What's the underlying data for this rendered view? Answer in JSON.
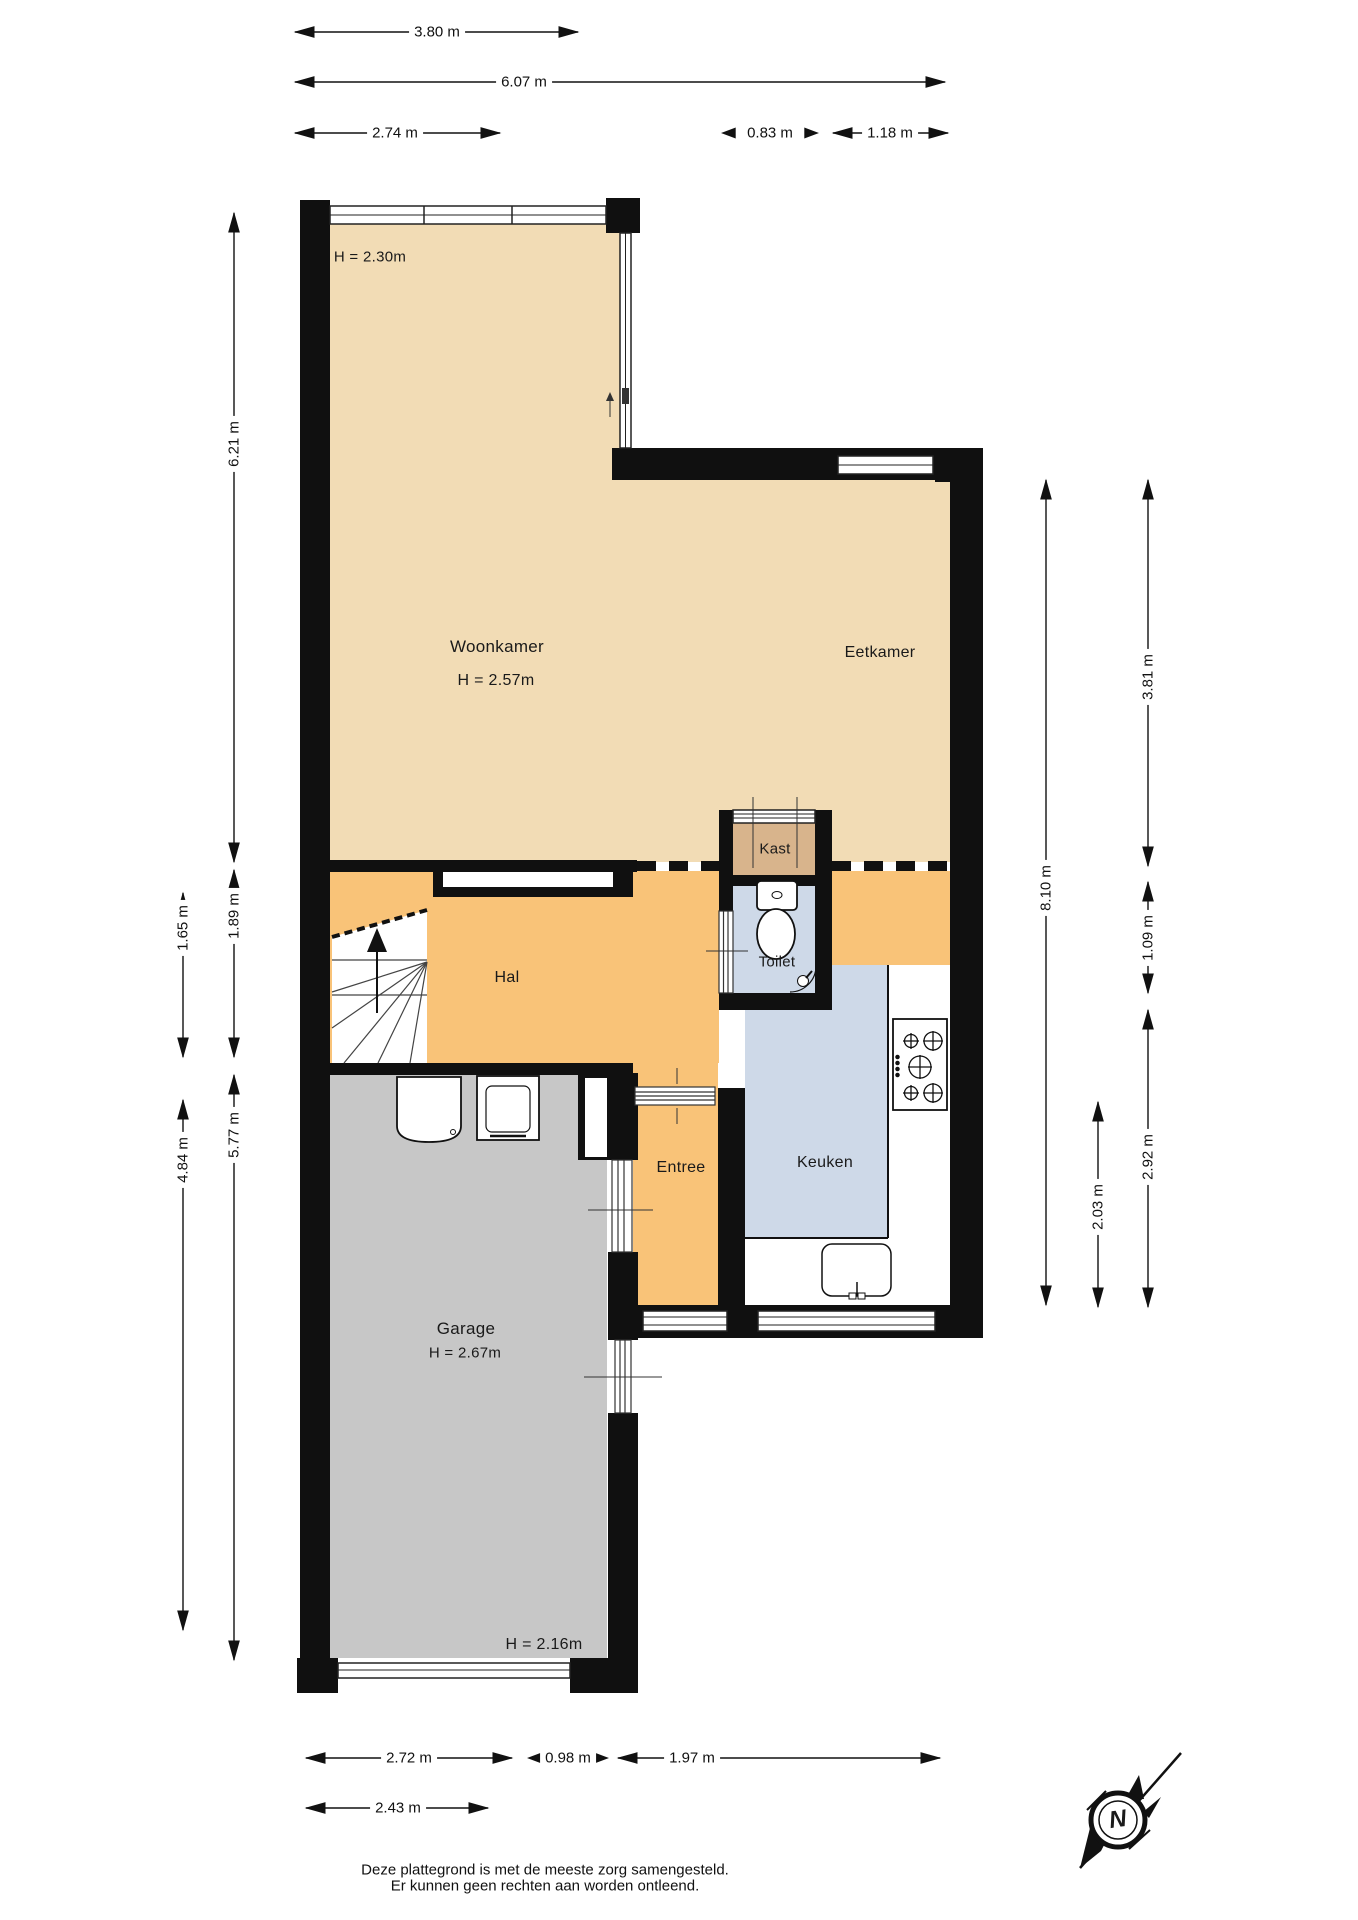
{
  "title": "Plattegrond begane grond",
  "colors": {
    "wall": "#101010",
    "living": "#f2dcb5",
    "hall": "#f9c378",
    "closet": "#d8b48c",
    "wet": "#ced9e8",
    "garage": "#c7c7c7",
    "line": "#1a1a1a",
    "bg": "#ffffff"
  },
  "rooms": {
    "woonkamer": {
      "label": "Woonkamer",
      "height_label": "H = 2.57m"
    },
    "eetkamer": {
      "label": "Eetkamer"
    },
    "kast": {
      "label": "Kast"
    },
    "hal": {
      "label": "Hal"
    },
    "toilet": {
      "label": "Toilet"
    },
    "entree": {
      "label": "Entree"
    },
    "keuken": {
      "label": "Keuken"
    },
    "garage": {
      "label": "Garage",
      "height_label": "H = 2.67m"
    },
    "serre_height": {
      "label": "H = 2.30m"
    },
    "garage_rear_height": {
      "label": "H = 2.16m"
    }
  },
  "dimensions": {
    "top": [
      "3.80 m",
      "6.07 m",
      "2.74 m",
      "0.83 m",
      "1.18 m"
    ],
    "left": [
      "6.21 m",
      "1.89 m",
      "1.65 m",
      "5.77 m",
      "4.84 m"
    ],
    "right": [
      "8.10 m",
      "3.81 m",
      "1.09 m",
      "2.92 m",
      "2.03 m"
    ],
    "bottom": [
      "2.72 m",
      "0.98 m",
      "1.97 m",
      "2.43 m"
    ]
  },
  "compass": {
    "label": "N"
  },
  "footer": {
    "line1": "Deze plattegrond is met de meeste zorg samengesteld.",
    "line2": "Er kunnen geen rechten aan worden ontleend."
  }
}
